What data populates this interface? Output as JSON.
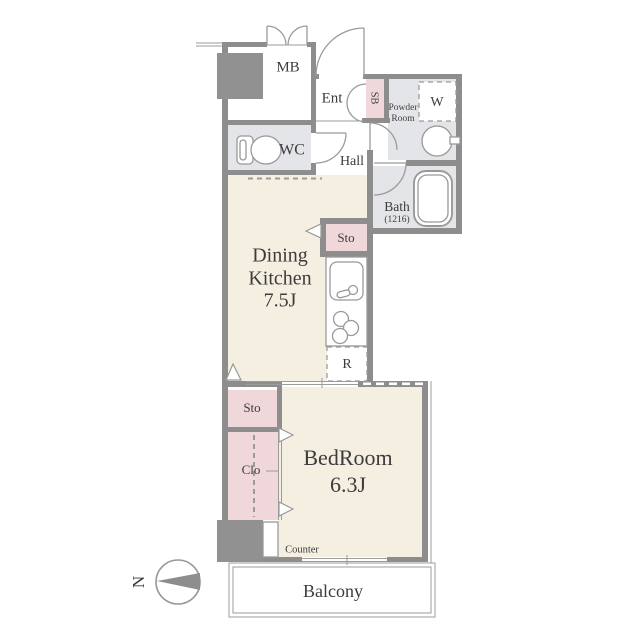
{
  "title": "Apartment floor plan 1K",
  "colors": {
    "floor_cream": "#f5efe2",
    "floor_pink": "#efd7da",
    "floor_gray": "#e4e5e9",
    "wall_gray": "#8d8d8d",
    "line_gray": "#9b9b9b",
    "text_gray": "#3c3c3c"
  },
  "rooms": {
    "mb": {
      "label": "MB"
    },
    "ent": {
      "label": "Ent"
    },
    "sb": {
      "label": "SB"
    },
    "powder_room": {
      "line1": "Powder",
      "line2": "Room"
    },
    "washer": {
      "label": "W"
    },
    "wc": {
      "label": "WC"
    },
    "hall": {
      "label": "Hall"
    },
    "bath": {
      "label": "Bath",
      "size": "(1216)"
    },
    "dining_kitchen": {
      "line1": "Dining",
      "line2": "Kitchen",
      "size": "7.5J"
    },
    "kitchen_storage": {
      "label": "Sto"
    },
    "refrigerator": {
      "label": "R"
    },
    "bedroom_storage": {
      "label": "Sto"
    },
    "closet": {
      "label": "Clo"
    },
    "bedroom": {
      "label": "BedRoom",
      "size": "6.3J"
    },
    "counter": {
      "label": "Counter"
    },
    "balcony": {
      "label": "Balcony"
    }
  },
  "compass": {
    "label": "N"
  }
}
